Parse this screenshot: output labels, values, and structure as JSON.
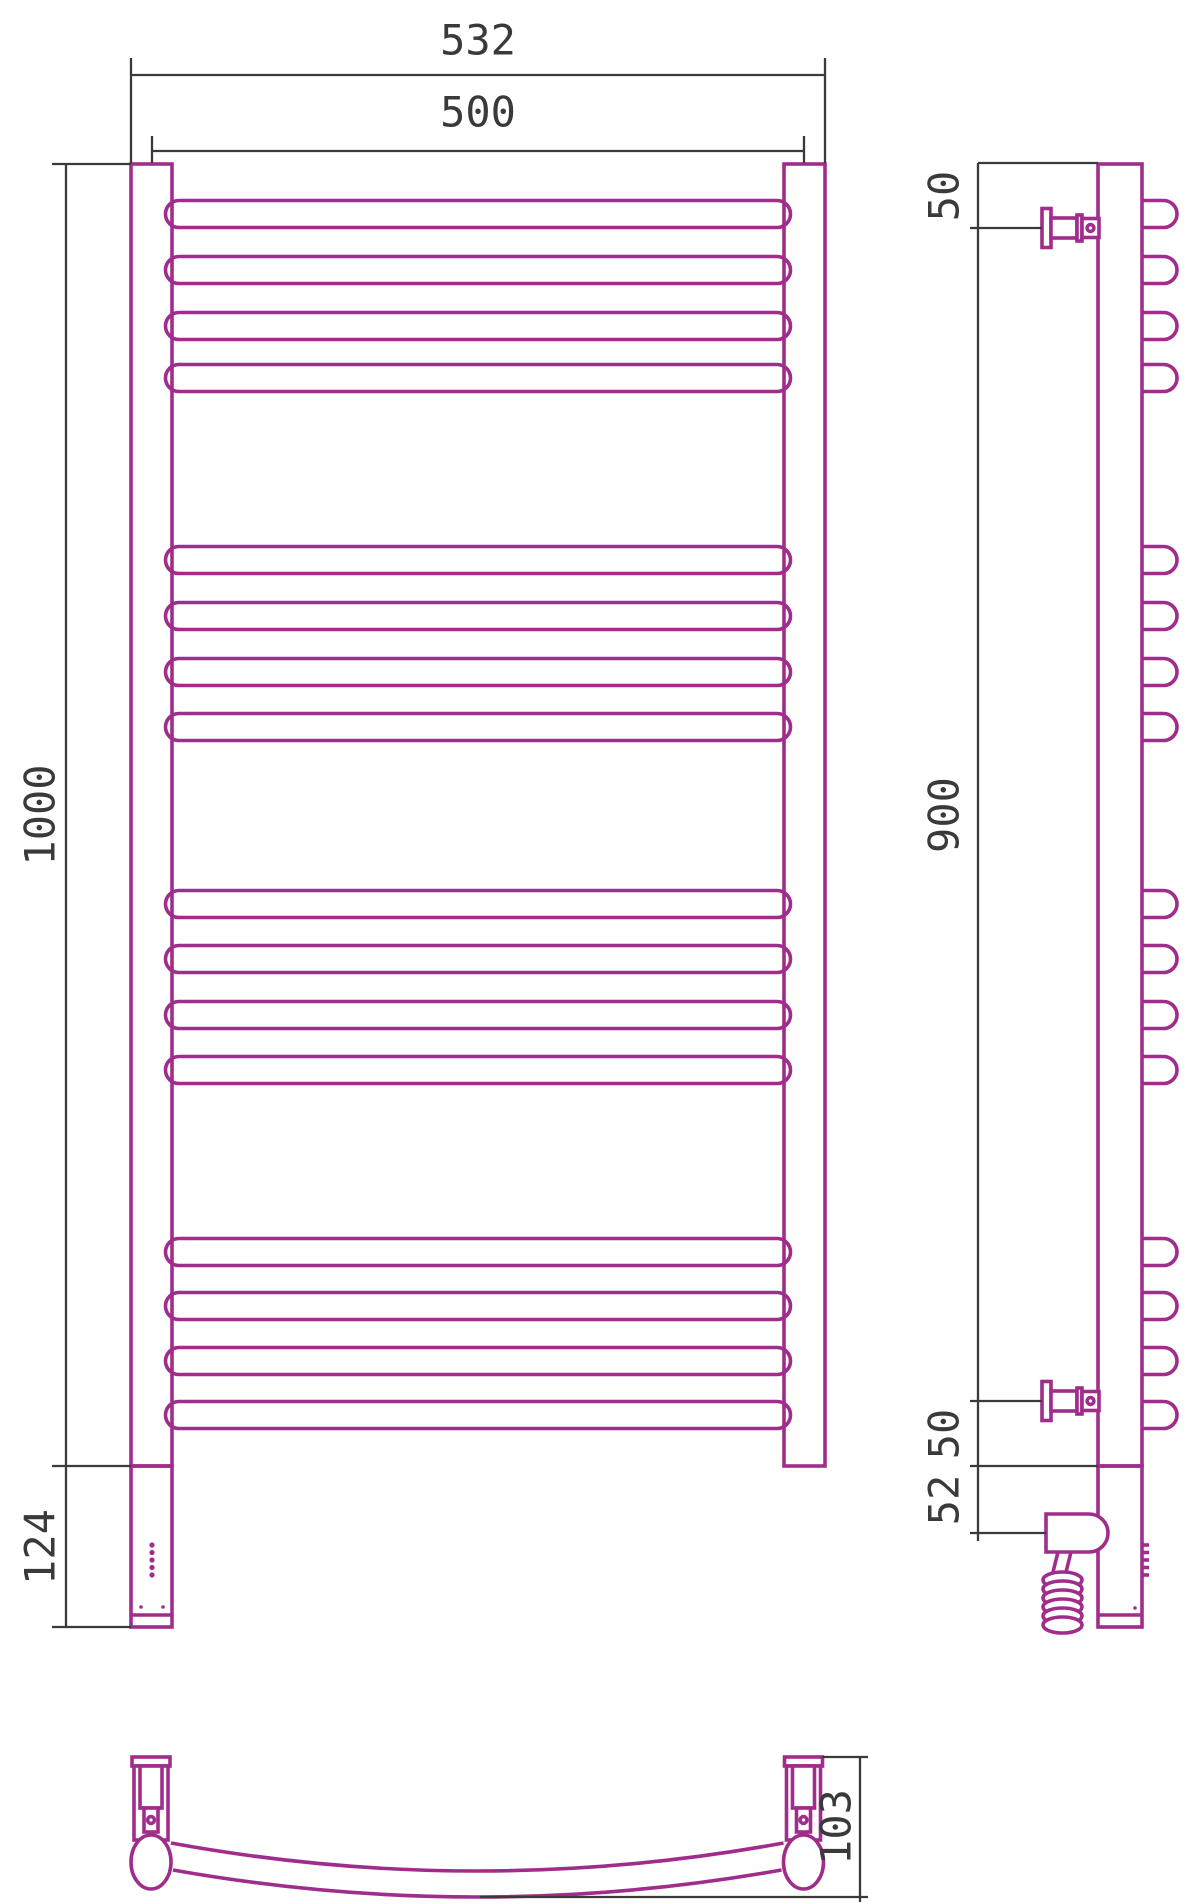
{
  "title": "Towel rail technical drawing (front, side and bottom views)",
  "colors": {
    "line": "#a02c8c",
    "dim": "#3a3a3a",
    "bg": "#ffffff",
    "fill": "#ffffff"
  },
  "stroke_widths": {
    "line": 3.6,
    "dim": 2.3
  },
  "font_size": 42,
  "dimensions": {
    "front": {
      "overall_width": "532",
      "rail_width": "500",
      "overall_height": "1000",
      "lower_section_height": "124"
    },
    "side": {
      "top_bracket_offset": "50",
      "bracket_span": "900",
      "bottom_bracket_offset": "50",
      "outlet_offset": "52"
    },
    "bottom": {
      "depth": "103"
    }
  },
  "labels": [
    {
      "name": "dim-label-532",
      "text": "532",
      "x": 478,
      "y": 40,
      "rot": 0
    },
    {
      "name": "dim-label-500",
      "text": "500",
      "x": 478,
      "y": 112,
      "rot": 0
    },
    {
      "name": "dim-label-1000",
      "text": "1000",
      "x": 40,
      "y": 815,
      "rot": -90
    },
    {
      "name": "dim-label-124",
      "text": "124",
      "x": 40,
      "y": 1547,
      "rot": -90
    },
    {
      "name": "dim-label-50-top",
      "text": "50",
      "x": 944,
      "y": 196,
      "rot": -90
    },
    {
      "name": "dim-label-900",
      "text": "900",
      "x": 944,
      "y": 815,
      "rot": -90
    },
    {
      "name": "dim-label-50-bottom",
      "text": "50",
      "x": 944,
      "y": 1434,
      "rot": -90
    },
    {
      "name": "dim-label-52",
      "text": "52",
      "x": 944,
      "y": 1500,
      "rot": -90
    },
    {
      "name": "dim-label-103",
      "text": "103",
      "x": 836,
      "y": 1827,
      "rot": -90
    }
  ],
  "drawing": {
    "canvas": {
      "w": 1200,
      "h": 1904
    },
    "bar_centers": [
      214,
      270,
      326,
      378,
      560,
      616,
      672,
      727,
      904,
      959,
      1015,
      1070,
      1252,
      1306,
      1361,
      1415
    ],
    "front": {
      "bar": {
        "x": 165.5,
        "w": 625,
        "h": 27
      },
      "left_post": {
        "x": 131,
        "y": 164,
        "w": 41,
        "h": 1302
      },
      "right_post": {
        "x": 784,
        "y": 164,
        "w": 41,
        "h": 1302
      },
      "lower_box": {
        "x": 131,
        "y": 1466,
        "w": 41,
        "h": 161
      },
      "foot_line_y": 1615,
      "led_dots": {
        "x": 152,
        "ys": [
          1545,
          1552.5,
          1560,
          1567.5,
          1575
        ],
        "r": 2.6
      },
      "screw_dots": [
        {
          "x": 141,
          "y": 1607,
          "r": 1.8
        },
        {
          "x": 163,
          "y": 1607,
          "r": 1.8
        }
      ]
    },
    "side": {
      "post": {
        "x": 1098,
        "y": 164,
        "w": 44,
        "h": 1302
      },
      "lower_box": {
        "x": 1098,
        "y": 1466,
        "w": 44,
        "h": 161
      },
      "foot_line_y": 1615,
      "stub": {
        "x": 1142,
        "flat": 21.5,
        "h": 27
      },
      "led_dashes": {
        "x1": 1142,
        "x2": 1149,
        "ys": [
          1545,
          1552.5,
          1560,
          1567.5,
          1575
        ]
      },
      "screw_dot": {
        "x": 1135,
        "y": 1608,
        "r": 1.8
      },
      "bracket_centers_y": [
        228,
        1401
      ],
      "bracket": {
        "flange": [
          1042,
          -19.5,
          9,
          39
        ],
        "pin": [
          1051,
          -10,
          26,
          20
        ],
        "collar": [
          1077,
          -13,
          5,
          26
        ],
        "head": [
          1082,
          -9.5,
          17,
          19
        ],
        "circle_x": 1090.5,
        "circle_r": 3.4
      },
      "housing": "M 1046 1514 H 1089 A 19 19 0 0 1 1108 1533 A 19 19 0 0 1 1089 1552 H 1046 Z",
      "wire": "M 1058 1552 L 1052 1576 M 1071 1552 L 1065 1576",
      "coil": {
        "cx": 1062.5,
        "rx": 19.5,
        "ry": 8,
        "cys": [
          1580,
          1589,
          1598,
          1607,
          1616,
          1625
        ]
      }
    },
    "bottom": {
      "arc_top": "M 171 1843 Q 477 1899 783.5 1843",
      "arc_bottom": "M 173 1870 Q 477 1924 781.5 1870",
      "fitting_cx": [
        151,
        803.5
      ],
      "bracket": {
        "plate": [
          -19,
          1757,
          38,
          9
        ],
        "body": [
          -17,
          1766,
          34,
          74
        ],
        "pin": [
          -11,
          1766,
          22,
          42
        ],
        "head": [
          -7,
          1808,
          14,
          24
        ],
        "circle_y": 1820,
        "circle_r": 3.4
      },
      "ellipse": {
        "cy": 1862,
        "rx": 20,
        "ry": 27
      }
    },
    "dim_lines": [
      {
        "name": "dim-line-532",
        "x1": 131,
        "y1": 75,
        "x2": 825,
        "y2": 75
      },
      {
        "name": "ext-532-left",
        "x1": 131,
        "y1": 58,
        "x2": 131,
        "y2": 163
      },
      {
        "name": "ext-532-right",
        "x1": 825,
        "y1": 58,
        "x2": 825,
        "y2": 163
      },
      {
        "name": "dim-line-500",
        "x1": 152,
        "y1": 151,
        "x2": 804,
        "y2": 151
      },
      {
        "name": "ext-500-left",
        "x1": 152,
        "y1": 136,
        "x2": 152,
        "y2": 163
      },
      {
        "name": "ext-500-right",
        "x1": 804,
        "y1": 136,
        "x2": 804,
        "y2": 163
      },
      {
        "name": "dim-line-1000",
        "x1": 66,
        "y1": 164,
        "x2": 66,
        "y2": 1466
      },
      {
        "name": "ext-1000-top",
        "x1": 52,
        "y1": 164,
        "x2": 131,
        "y2": 164
      },
      {
        "name": "ext-1000-bottom",
        "x1": 52,
        "y1": 1466,
        "x2": 131,
        "y2": 1466
      },
      {
        "name": "dim-line-124",
        "x1": 66,
        "y1": 1466,
        "x2": 66,
        "y2": 1627
      },
      {
        "name": "ext-124-bottom",
        "x1": 52,
        "y1": 1627,
        "x2": 131,
        "y2": 1627
      },
      {
        "name": "dim-line-side",
        "x1": 978,
        "y1": 163,
        "x2": 978,
        "y2": 1541
      },
      {
        "name": "ext-side-post-top",
        "x1": 978,
        "y1": 163,
        "x2": 1098,
        "y2": 163
      },
      {
        "name": "ext-side-bracket-top",
        "x1": 970,
        "y1": 228,
        "x2": 1042,
        "y2": 228
      },
      {
        "name": "ext-side-bracket-bot",
        "x1": 970,
        "y1": 1401,
        "x2": 1042,
        "y2": 1401
      },
      {
        "name": "ext-side-post-bot",
        "x1": 970,
        "y1": 1466,
        "x2": 1098,
        "y2": 1466
      },
      {
        "name": "ext-side-outlet",
        "x1": 970,
        "y1": 1533,
        "x2": 1046,
        "y2": 1533
      },
      {
        "name": "dim-line-103",
        "x1": 860,
        "y1": 1757,
        "x2": 860,
        "y2": 1902
      },
      {
        "name": "ext-103-top",
        "x1": 822,
        "y1": 1757,
        "x2": 868,
        "y2": 1757
      },
      {
        "name": "ext-103-bottom",
        "x1": 480,
        "y1": 1897,
        "x2": 868,
        "y2": 1897
      }
    ]
  }
}
